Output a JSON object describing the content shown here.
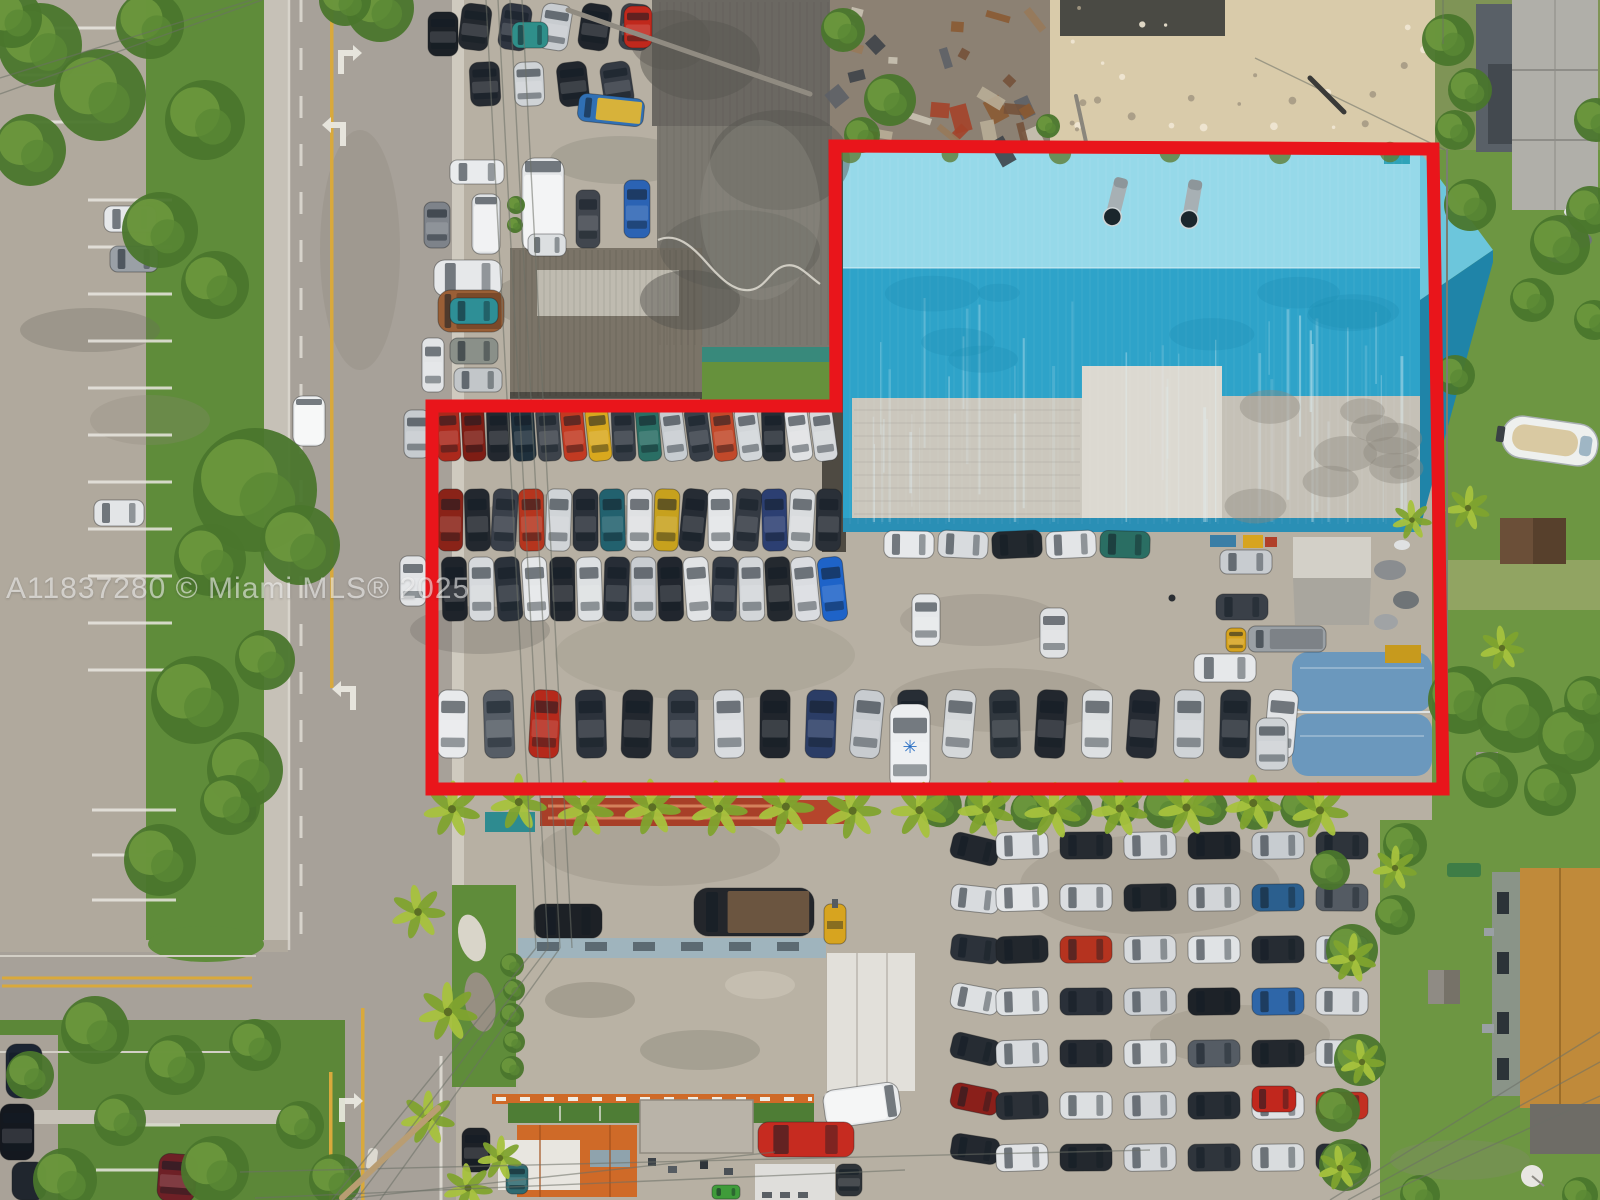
{
  "watermark": {
    "text": "A11837280 © Miami MLS® 2025"
  },
  "colors": {
    "boundary": "#e9151b",
    "road": "#a7a199",
    "pavement": "#b4ad9f",
    "dealer_pavement": "#b7b0a3",
    "grass": "#5f8c3a",
    "yard_grass": "#6d9642",
    "sand": "#d9cbaa",
    "junk_base": "#8c8173",
    "warehouse_top": "#96d9e9",
    "warehouse_main": "#2ea3c9",
    "warehouse_fascia": "#2a8fb5",
    "concrete": "#dcd9d1",
    "concrete_left": "#cbc7bd",
    "concrete_right": "#c5c1b7",
    "dark_roof": "#7b7870",
    "dark_roof_upper": "#6b6862",
    "teal_trim": "#38897b",
    "brown_roof": "#7b7468",
    "quonset": "#6b98bd",
    "shop_roof": "#b9b2a4",
    "shop_band": "#9fb4bd",
    "canopy": "#e2e0da",
    "orange_roof": "#cf6a28",
    "house_roof": "#c08a3a",
    "house_wall": "#8a9488",
    "gray_roof": "#b0afa9",
    "yellow_line": "#d9a93c",
    "white_marking": "#eceae2",
    "palm_green": "#a6c23d",
    "tree_green": "#4a762c"
  },
  "boundary": {
    "stroke_width": 13
  },
  "road": {
    "arrows": [
      {
        "x": 345,
        "y": 48,
        "dir": "right"
      },
      {
        "x": 339,
        "y": 120,
        "dir": "left"
      },
      {
        "x": 349,
        "y": 684,
        "dir": "left"
      },
      {
        "x": 346,
        "y": 1096,
        "dir": "right"
      },
      {
        "x": 342,
        "y": 1164,
        "dir": "left"
      }
    ],
    "stripe_columns": [
      {
        "x": 88,
        "w": 84,
        "y0": 200,
        "step": 47,
        "count": 11
      },
      {
        "x": 92,
        "w": 84,
        "y0": 810,
        "step": 45,
        "count": 3
      },
      {
        "x": 96,
        "w": 84,
        "y0": 1125,
        "step": 45,
        "count": 2
      },
      {
        "x": 18,
        "w": 97,
        "y0": 28,
        "step": 47,
        "count": 3
      }
    ]
  },
  "car_lots": [
    {
      "name": "inventory-row-top",
      "x": 437,
      "y": 407,
      "dx": 25,
      "dy": 0,
      "count": 16,
      "w": 23,
      "h": 54,
      "angle": -4,
      "jitter": 4,
      "palette": [
        "#ab291c",
        "#7e1d14",
        "#23282f",
        "#1f303c",
        "#3d434b",
        "#c23a22",
        "#d8a81e",
        "#353c45",
        "#2a6e64",
        "#c7ccd0",
        "#394049",
        "#c2492a",
        "#d2d6d9",
        "#272d35",
        "#e0e2e4",
        "#d5d8db"
      ]
    },
    {
      "name": "inventory-row-mid-a",
      "x": 438,
      "y": 489,
      "dx": 27,
      "dy": 0,
      "count": 15,
      "w": 25,
      "h": 62,
      "angle": 2,
      "jitter": 4,
      "palette": [
        "#8a2318",
        "#23282f",
        "#3a404a",
        "#b5351e",
        "#d0d4d7",
        "#2b313a",
        "#22616e",
        "#dfe1e3",
        "#c7a11d",
        "#262c34",
        "#e3e5e7",
        "#343a43",
        "#2c3f72",
        "#d9dcde",
        "#2a3038"
      ]
    },
    {
      "name": "inventory-row-mid-b",
      "x": 442,
      "y": 557,
      "dx": 27,
      "dy": 0,
      "count": 15,
      "w": 25,
      "h": 64,
      "angle": -2,
      "jitter": 4,
      "palette": [
        "#1f242b",
        "#d6d9dc",
        "#2b323b",
        "#e4e6e8",
        "#23282f",
        "#dde0e2",
        "#272d36",
        "#c9cdd1",
        "#21262e",
        "#e1e3e5",
        "#323943",
        "#d3d6d9",
        "#24292f",
        "#dadce0",
        "#1e63c8"
      ]
    },
    {
      "name": "row-under-warehouse",
      "x": 884,
      "y": 531,
      "dx": 54,
      "dy": 0,
      "count": 5,
      "w": 50,
      "h": 27,
      "angle": 0,
      "jitter": 3,
      "palette": [
        "#e7e9eb",
        "#d8dbde",
        "#22282e",
        "#e3e5e7",
        "#2a6e63"
      ]
    },
    {
      "name": "inventory-row-bottom",
      "x": 438,
      "y": 690,
      "dx": 46,
      "dy": 0,
      "count": 19,
      "w": 30,
      "h": 68,
      "angle": 2,
      "jitter": 4,
      "palette": [
        "#e8eaec",
        "#565d66",
        "#b5291b",
        "#2c323b",
        "#23282f",
        "#3a414b",
        "#d9dcdf",
        "#20252c",
        "#2b3d66",
        "#c8ccd0",
        "#272d35",
        "#d5d8da",
        "#31383f",
        "#22272e",
        "#dde0e2",
        "#262b33",
        "#d0d4d7",
        "#2a3139",
        "#e2e4e6"
      ]
    },
    {
      "name": "north-lot-row-1",
      "x": 460,
      "y": 4,
      "dx": 40,
      "dy": 0,
      "count": 5,
      "w": 30,
      "h": 46,
      "angle": 6,
      "jitter": 5,
      "palette": [
        "#23282e",
        "#2f3540",
        "#c8ccd0",
        "#1f242b",
        "#3b414a"
      ]
    },
    {
      "name": "north-lot-row-2",
      "x": 470,
      "y": 62,
      "dx": 44,
      "dy": 0,
      "count": 4,
      "w": 30,
      "h": 44,
      "angle": -5,
      "jitter": 5,
      "palette": [
        "#262b32",
        "#cfd3d6",
        "#21262d",
        "#343a43"
      ]
    },
    {
      "name": "se-lot-left-column",
      "x": 951,
      "y": 836,
      "dx": 0,
      "dy": 50,
      "count": 7,
      "w": 48,
      "h": 26,
      "angle": 10,
      "jitter": 4,
      "palette": [
        "#22272e",
        "#d8dbde",
        "#2c323a",
        "#dde0e2",
        "#262c33",
        "#8a1f1a",
        "#23282f"
      ]
    },
    {
      "name": "se-lot-row-1",
      "x": 996,
      "y": 832,
      "dx": 64,
      "dy": 0,
      "count": 6,
      "w": 52,
      "h": 27,
      "angle": 0,
      "jitter": 3,
      "palette": [
        "#dde0e3",
        "#262b31",
        "#d5d8db",
        "#1f242a",
        "#c7ccd0",
        "#2e343b"
      ]
    },
    {
      "name": "se-lot-row-2",
      "x": 996,
      "y": 884,
      "dx": 64,
      "dy": 0,
      "count": 6,
      "w": 52,
      "h": 27,
      "angle": 0,
      "jitter": 3,
      "palette": [
        "#e4e6e8",
        "#dadde0",
        "#23282e",
        "#d2d5d8",
        "#2b5f8e",
        "#545b63"
      ]
    },
    {
      "name": "se-lot-row-3",
      "x": 996,
      "y": 936,
      "dx": 64,
      "dy": 0,
      "count": 6,
      "w": 52,
      "h": 27,
      "angle": 0,
      "jitter": 3,
      "palette": [
        "#22272d",
        "#b5331f",
        "#d7dadd",
        "#e0e3e5",
        "#262c33",
        "#d9dcdf"
      ]
    },
    {
      "name": "se-lot-row-4",
      "x": 996,
      "y": 988,
      "dx": 64,
      "dy": 0,
      "count": 6,
      "w": 52,
      "h": 27,
      "angle": 0,
      "jitter": 3,
      "palette": [
        "#dfe2e4",
        "#2a3039",
        "#cdd1d5",
        "#1d2228",
        "#2e66a8",
        "#d8dbde"
      ]
    },
    {
      "name": "se-lot-row-5",
      "x": 996,
      "y": 1040,
      "dx": 64,
      "dy": 0,
      "count": 6,
      "w": 52,
      "h": 27,
      "angle": 0,
      "jitter": 3,
      "palette": [
        "#d8dbde",
        "#272c33",
        "#dde0e2",
        "#555c64",
        "#23282e",
        "#dadde0"
      ]
    },
    {
      "name": "se-lot-row-6",
      "x": 996,
      "y": 1092,
      "dx": 64,
      "dy": 0,
      "count": 6,
      "w": 52,
      "h": 27,
      "angle": 0,
      "jitter": 3,
      "palette": [
        "#2c3138",
        "#dcdfe1",
        "#d3d6d9",
        "#272d34",
        "#dfe1e4",
        "#c23022"
      ]
    },
    {
      "name": "se-lot-row-7",
      "x": 996,
      "y": 1144,
      "dx": 64,
      "dy": 0,
      "count": 6,
      "w": 52,
      "h": 27,
      "angle": 0,
      "jitter": 3,
      "palette": [
        "#e1e3e5",
        "#23282e",
        "#d6d9dc",
        "#2f353c",
        "#d9dcde",
        "#282e35"
      ]
    }
  ],
  "vehicles": [
    {
      "x": 293,
      "y": 396,
      "w": 32,
      "h": 50,
      "c": "#edeff0",
      "kind": "box",
      "n": "box-truck-on-road"
    },
    {
      "x": 104,
      "y": 206,
      "w": 52,
      "h": 26,
      "c": "#e6e8ea"
    },
    {
      "x": 110,
      "y": 246,
      "w": 48,
      "h": 26,
      "c": "#9aa0a6"
    },
    {
      "x": 94,
      "y": 500,
      "w": 50,
      "h": 26,
      "c": "#e3e5e7"
    },
    {
      "x": 428,
      "y": 12,
      "w": 30,
      "h": 44,
      "c": "#1b2026"
    },
    {
      "x": 578,
      "y": 96,
      "w": 66,
      "h": 28,
      "c": "#3070b5",
      "a": 6,
      "kind": "flatbed",
      "bc": "#d7b23a"
    },
    {
      "x": 512,
      "y": 22,
      "w": 36,
      "h": 26,
      "c": "#2f8f8a"
    },
    {
      "x": 624,
      "y": 6,
      "w": 28,
      "h": 42,
      "c": "#c0281c"
    },
    {
      "x": 450,
      "y": 160,
      "w": 54,
      "h": 24,
      "c": "#e9ebed"
    },
    {
      "x": 424,
      "y": 202,
      "w": 26,
      "h": 46,
      "c": "#7e838a"
    },
    {
      "x": 472,
      "y": 194,
      "w": 28,
      "h": 60,
      "c": "#dfe2e4",
      "kind": "box"
    },
    {
      "x": 522,
      "y": 158,
      "w": 42,
      "h": 94,
      "c": "#e4e6e8",
      "kind": "box"
    },
    {
      "x": 528,
      "y": 234,
      "w": 38,
      "h": 22,
      "c": "#dcdfe1"
    },
    {
      "x": 576,
      "y": 190,
      "w": 24,
      "h": 58,
      "c": "#41464e"
    },
    {
      "x": 624,
      "y": 180,
      "w": 26,
      "h": 58,
      "c": "#2b63b4"
    },
    {
      "x": 434,
      "y": 260,
      "w": 68,
      "h": 36,
      "c": "#e6e8ea"
    },
    {
      "x": 438,
      "y": 290,
      "w": 66,
      "h": 42,
      "c": "#9a5f36",
      "kind": "flatbed",
      "bc": "#7a4a2a"
    },
    {
      "x": 450,
      "y": 298,
      "w": 48,
      "h": 26,
      "c": "#2e8f96"
    },
    {
      "x": 450,
      "y": 338,
      "w": 48,
      "h": 26,
      "c": "#8a9089"
    },
    {
      "x": 422,
      "y": 338,
      "w": 22,
      "h": 54,
      "c": "#e2e4e6"
    },
    {
      "x": 454,
      "y": 368,
      "w": 48,
      "h": 24,
      "c": "#c2c6c9"
    },
    {
      "x": 404,
      "y": 410,
      "w": 26,
      "h": 48,
      "c": "#c6cbcf"
    },
    {
      "x": 400,
      "y": 556,
      "w": 26,
      "h": 50,
      "c": "#e2e4e6"
    },
    {
      "x": 912,
      "y": 594,
      "w": 28,
      "h": 52,
      "c": "#e6e8ea"
    },
    {
      "x": 1040,
      "y": 608,
      "w": 28,
      "h": 50,
      "c": "#dfe1e3"
    },
    {
      "x": 1220,
      "y": 550,
      "w": 52,
      "h": 24,
      "c": "#c8ccd0"
    },
    {
      "x": 1216,
      "y": 594,
      "w": 52,
      "h": 26,
      "c": "#3a4048"
    },
    {
      "x": 1226,
      "y": 628,
      "w": 20,
      "h": 24,
      "c": "#d7a41f"
    },
    {
      "x": 1248,
      "y": 626,
      "w": 78,
      "h": 26,
      "c": "#9aa0a5",
      "kind": "flatbed",
      "bc": "#7d8287"
    },
    {
      "x": 1194,
      "y": 654,
      "w": 62,
      "h": 28,
      "c": "#e6e8ea"
    },
    {
      "x": 1256,
      "y": 718,
      "w": 32,
      "h": 52,
      "c": "#ced2d5"
    },
    {
      "x": 890,
      "y": 704,
      "w": 40,
      "h": 86,
      "c": "#eceef0",
      "kind": "star",
      "n": "van-with-blue-star"
    },
    {
      "x": 694,
      "y": 888,
      "w": 120,
      "h": 48,
      "c": "#23262b",
      "kind": "flatbed",
      "bc": "#6b5540",
      "n": "flatbed-truck"
    },
    {
      "x": 534,
      "y": 904,
      "w": 68,
      "h": 34,
      "c": "#1d2126"
    },
    {
      "x": 824,
      "y": 904,
      "w": 22,
      "h": 40,
      "c": "#d7a41f",
      "kind": "fork",
      "n": "forklift"
    },
    {
      "x": 824,
      "y": 1086,
      "w": 76,
      "h": 38,
      "c": "#e9ebec",
      "a": -8,
      "kind": "box"
    },
    {
      "x": 758,
      "y": 1122,
      "w": 96,
      "h": 35,
      "c": "#c62b20",
      "n": "red-box-truck"
    },
    {
      "x": 836,
      "y": 1164,
      "w": 26,
      "h": 32,
      "c": "#2e3338"
    },
    {
      "x": 712,
      "y": 1185,
      "w": 28,
      "h": 14,
      "c": "#3f9c3a"
    },
    {
      "x": 506,
      "y": 1164,
      "w": 22,
      "h": 30,
      "c": "#2e6a70"
    },
    {
      "x": 462,
      "y": 1128,
      "w": 28,
      "h": 44,
      "c": "#1d2127"
    },
    {
      "x": 158,
      "y": 1154,
      "w": 38,
      "h": 48,
      "c": "#6e2026",
      "a": 4
    },
    {
      "x": 6,
      "y": 1044,
      "w": 36,
      "h": 54,
      "c": "#1c2533"
    },
    {
      "x": 0,
      "y": 1104,
      "w": 34,
      "h": 56,
      "c": "#14181f"
    },
    {
      "x": 12,
      "y": 1162,
      "w": 34,
      "h": 38,
      "c": "#20262e"
    },
    {
      "x": 226,
      "y": 796,
      "w": 30,
      "h": 26,
      "c": "#232830"
    },
    {
      "x": 1252,
      "y": 1086,
      "w": 44,
      "h": 26,
      "c": "#c1271d",
      "n": "red-sports-car"
    }
  ],
  "palms": {
    "row_y": 806,
    "row_x_start": 452,
    "row_x_end": 1320,
    "row_count": 14,
    "row_scale": 1.15,
    "extras": [
      [
        418,
        912,
        1.1
      ],
      [
        448,
        1012,
        1.2
      ],
      [
        428,
        1118,
        1.1
      ],
      [
        468,
        1188,
        1.0
      ],
      [
        500,
        1158,
        0.9
      ],
      [
        1395,
        868,
        0.9
      ],
      [
        1352,
        958,
        1.0
      ],
      [
        1362,
        1062,
        0.9
      ],
      [
        1412,
        520,
        0.8
      ],
      [
        1468,
        508,
        0.9
      ],
      [
        1502,
        648,
        0.9
      ],
      [
        1340,
        1168,
        0.9
      ]
    ]
  },
  "hedge_row": {
    "x_start": 940,
    "x_end": 1300,
    "step": 45,
    "y": 808,
    "r": 17
  },
  "trees": [
    [
      40,
      45,
      42
    ],
    [
      100,
      95,
      46
    ],
    [
      30,
      150,
      36
    ],
    [
      150,
      25,
      34
    ],
    [
      205,
      120,
      40
    ],
    [
      160,
      230,
      38
    ],
    [
      215,
      285,
      34
    ],
    [
      255,
      490,
      62
    ],
    [
      300,
      545,
      40
    ],
    [
      210,
      560,
      36
    ],
    [
      195,
      700,
      44
    ],
    [
      245,
      770,
      38
    ],
    [
      160,
      860,
      36
    ],
    [
      265,
      660,
      30
    ],
    [
      230,
      805,
      30
    ],
    [
      12,
      18,
      30
    ],
    [
      380,
      8,
      34
    ],
    [
      345,
      0,
      26
    ],
    [
      95,
      1030,
      34
    ],
    [
      175,
      1065,
      30
    ],
    [
      255,
      1045,
      26
    ],
    [
      120,
      1120,
      26
    ],
    [
      65,
      1180,
      32
    ],
    [
      215,
      1170,
      34
    ],
    [
      300,
      1125,
      24
    ],
    [
      335,
      1180,
      26
    ],
    [
      30,
      1075,
      24
    ],
    [
      843,
      30,
      22
    ],
    [
      890,
      100,
      26
    ],
    [
      862,
      135,
      18
    ],
    [
      1048,
      126,
      12
    ],
    [
      1448,
      40,
      26
    ],
    [
      1470,
      90,
      22
    ],
    [
      1455,
      130,
      20
    ],
    [
      1596,
      120,
      22
    ],
    [
      1590,
      210,
      24
    ],
    [
      1560,
      245,
      30
    ],
    [
      1470,
      205,
      26
    ],
    [
      1532,
      300,
      22
    ],
    [
      1594,
      320,
      20
    ],
    [
      1455,
      375,
      20
    ],
    [
      1462,
      700,
      34
    ],
    [
      1515,
      715,
      38
    ],
    [
      1572,
      740,
      34
    ],
    [
      1490,
      780,
      28
    ],
    [
      1550,
      790,
      26
    ],
    [
      1588,
      700,
      24
    ],
    [
      1405,
      845,
      22
    ],
    [
      1395,
      915,
      20
    ],
    [
      1352,
      950,
      26
    ],
    [
      1360,
      1060,
      26
    ],
    [
      1345,
      1165,
      26
    ],
    [
      1420,
      1195,
      20
    ],
    [
      1580,
      1195,
      18
    ],
    [
      1330,
      870,
      20
    ],
    [
      1338,
      1110,
      22
    ],
    [
      512,
      965,
      12
    ],
    [
      514,
      990,
      11
    ],
    [
      512,
      1015,
      12
    ],
    [
      514,
      1042,
      11
    ],
    [
      512,
      1068,
      12
    ],
    [
      516,
      205,
      9
    ],
    [
      515,
      225,
      8
    ]
  ],
  "weed_dots": [
    [
      850,
      152
    ],
    [
      950,
      154
    ],
    [
      1060,
      153
    ],
    [
      1170,
      152
    ],
    [
      1280,
      153
    ],
    [
      1390,
      152
    ]
  ],
  "wires": [
    [
      486,
      0,
      536,
      948
    ],
    [
      498,
      0,
      548,
      948
    ],
    [
      510,
      0,
      560,
      948
    ],
    [
      522,
      0,
      572,
      948
    ],
    [
      536,
      948,
      332,
      1200
    ],
    [
      548,
      948,
      356,
      1200
    ],
    [
      560,
      948,
      380,
      1200
    ],
    [
      0,
      78,
      252,
      0
    ],
    [
      0,
      94,
      262,
      0
    ],
    [
      240,
      1172,
      1150,
      1150
    ],
    [
      255,
      1198,
      905,
      1170
    ],
    [
      335,
      1200,
      775,
      1152
    ],
    [
      1330,
      1200,
      1600,
      1032
    ],
    [
      1348,
      1200,
      1600,
      1062
    ],
    [
      1372,
      1200,
      1600,
      1096
    ],
    [
      1255,
      58,
      1445,
      150
    ],
    [
      1443,
      0,
      1443,
      44
    ]
  ],
  "poles": [
    {
      "x1": 438,
      "y1": 1108,
      "x2": 342,
      "y2": 1198,
      "w": 6,
      "c": "#b99d72"
    },
    {
      "x1": 568,
      "y1": 10,
      "x2": 810,
      "y2": 94,
      "w": 5,
      "c": "#908b81"
    },
    {
      "x1": 1076,
      "y1": 96,
      "x2": 1086,
      "y2": 142,
      "w": 4,
      "c": "#8a867c"
    },
    {
      "x1": 1310,
      "y1": 78,
      "x2": 1344,
      "y2": 112,
      "w": 5,
      "c": "#3a3a38"
    },
    {
      "x1": 1447,
      "y1": 150,
      "x2": 1447,
      "y2": 690,
      "w": 2,
      "c": "#7a7d72"
    }
  ],
  "boat": {
    "x": 1550,
    "y": 441,
    "rot": 8
  }
}
